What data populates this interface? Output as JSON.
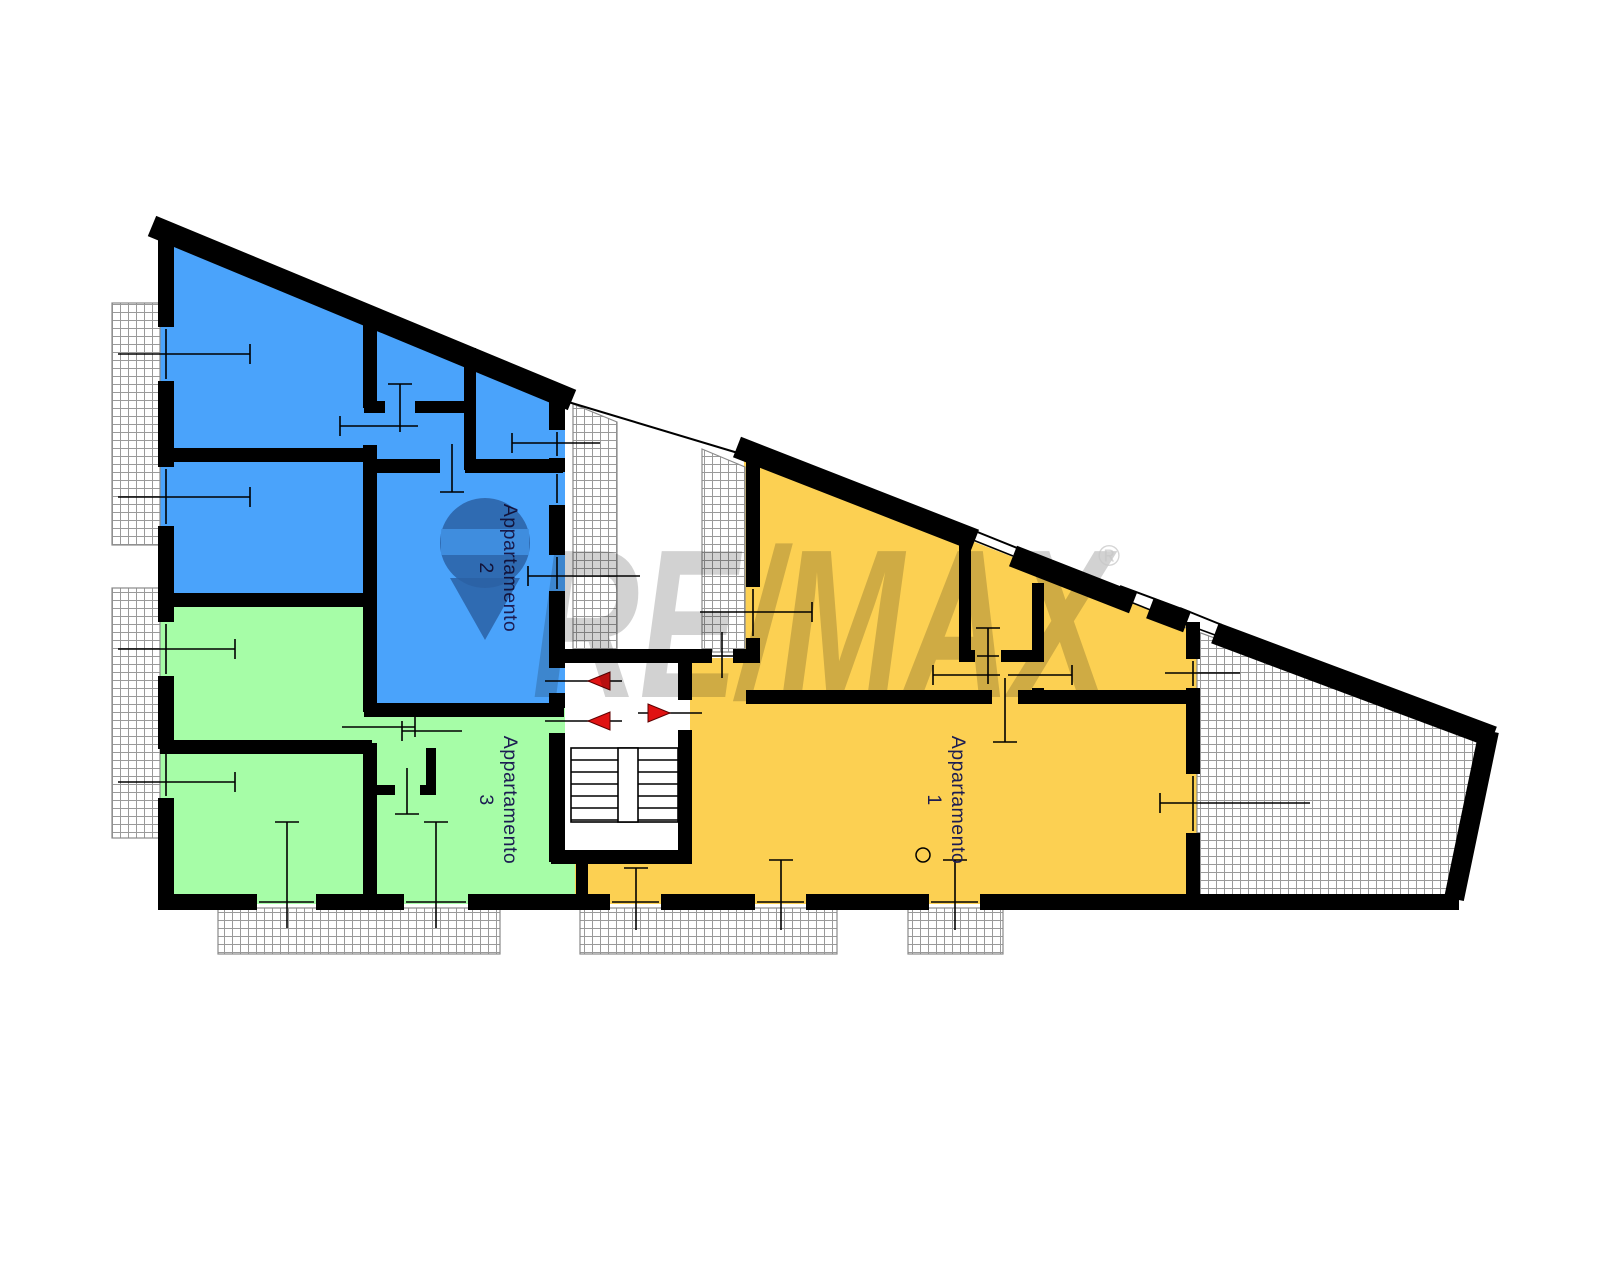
{
  "labels": {
    "apartment1": "Appartamento 1",
    "apartment2": "Appartamento 2",
    "apartment3": "Appartamento 3"
  },
  "watermark": {
    "text": "RE/MAX",
    "registered": "®",
    "x": 532,
    "y": 697,
    "font_size": 212,
    "text_length": 578,
    "reg_x": 1098,
    "reg_y": 566,
    "balloon": {
      "cx": 485,
      "cy": 543,
      "r": 45,
      "band": [
        441,
        529,
        88,
        26
      ],
      "tip": "450,578 520,578 485,640"
    }
  },
  "colors": {
    "apartment1": "#FCD052",
    "apartment2": "#4AA3FB",
    "apartment3": "#A6FDA7",
    "wall": "#000000",
    "hatch_line": "#9a9a9a",
    "hatch_border": "#8a8a8a",
    "door_marker": "#E01212",
    "door_marker_edge": "#5d0000",
    "label_text": "#1c1c52",
    "watermark_gray": "#c7c7c7",
    "balloon_gray": "#9298a8",
    "balloon_band": "#dfe2e8"
  },
  "floorplan": {
    "fills": [
      {
        "name": "apartment-2-area",
        "shape": "poly",
        "color": "apartment2",
        "pts": [
          "158,233",
          "565,402",
          "565,705",
          "363,705",
          "363,604",
          "158,604"
        ]
      },
      {
        "name": "apartment-3-area",
        "shape": "rect",
        "color": "apartment3",
        "rect": [
          158,
          598,
          214,
          306
        ]
      },
      {
        "name": "apartment-3-area",
        "shape": "rect",
        "color": "apartment3",
        "rect": [
          363,
          703,
          202,
          201
        ]
      },
      {
        "name": "apartment-3-area",
        "shape": "rect",
        "color": "apartment3",
        "rect": [
          549,
          858,
          30,
          46
        ]
      },
      {
        "name": "apartment-1-area",
        "shape": "poly",
        "color": "apartment1",
        "pts": [
          "744,452",
          "1200,630",
          "1200,904",
          "575,904",
          "575,855",
          "690,855",
          "690,658",
          "744,658"
        ]
      }
    ],
    "hatch_areas": [
      {
        "name": "balcony-top-left",
        "shape": "rect",
        "rect": [
          112,
          303,
          48,
          242
        ]
      },
      {
        "name": "balcony-left",
        "shape": "rect",
        "rect": [
          112,
          588,
          48,
          250
        ]
      },
      {
        "name": "balcony-bottom-left",
        "shape": "rect",
        "rect": [
          218,
          908,
          282,
          46
        ]
      },
      {
        "name": "balcony-bottom-center",
        "shape": "rect",
        "rect": [
          580,
          908,
          257,
          46
        ]
      },
      {
        "name": "balcony-bottom-right",
        "shape": "rect",
        "rect": [
          908,
          908,
          95,
          46
        ]
      },
      {
        "name": "light-well-1",
        "shape": "poly",
        "pts": [
          "573,404",
          "617,422",
          "617,651",
          "573,651"
        ]
      },
      {
        "name": "light-well-2",
        "shape": "poly",
        "pts": [
          "702,449",
          "745,467",
          "745,652",
          "702,652"
        ]
      },
      {
        "name": "terrace",
        "shape": "poly",
        "pts": [
          "1165,620",
          "1490,738",
          "1453,900",
          "1197,900",
          "1197,632"
        ]
      }
    ],
    "walls": [
      [
        152,
        226,
        572,
        400,
        22
      ],
      [
        166,
        228,
        166,
        327,
        16
      ],
      [
        166,
        381,
        166,
        467,
        16
      ],
      [
        166,
        526,
        166,
        622,
        16
      ],
      [
        166,
        676,
        166,
        749,
        16
      ],
      [
        166,
        798,
        166,
        908,
        16
      ],
      [
        158,
        902,
        257,
        902,
        16
      ],
      [
        316,
        902,
        404,
        902,
        16
      ],
      [
        468,
        902,
        610,
        902,
        16
      ],
      [
        661,
        902,
        755,
        902,
        16
      ],
      [
        806,
        902,
        929,
        902,
        16
      ],
      [
        980,
        902,
        1459,
        902,
        16
      ],
      [
        737,
        447,
        975,
        540,
        22
      ],
      [
        1013,
        556,
        1133,
        603,
        22
      ],
      [
        1150,
        608,
        1187,
        622,
        22
      ],
      [
        1215,
        633,
        1493,
        737,
        22
      ],
      [
        1489,
        731,
        1454,
        899,
        20
      ],
      [
        160,
        455,
        372,
        455,
        14
      ],
      [
        370,
        323,
        370,
        408,
        14
      ],
      [
        370,
        445,
        370,
        712,
        14
      ],
      [
        370,
        743,
        370,
        896,
        14
      ],
      [
        364,
        407,
        385,
        407,
        12
      ],
      [
        415,
        407,
        474,
        407,
        12
      ],
      [
        470,
        348,
        470,
        470,
        12
      ],
      [
        364,
        466,
        440,
        466,
        14
      ],
      [
        465,
        466,
        563,
        466,
        14
      ],
      [
        557,
        398,
        557,
        430,
        16
      ],
      [
        557,
        458,
        557,
        472,
        16
      ],
      [
        557,
        505,
        557,
        555,
        16
      ],
      [
        557,
        591,
        557,
        668,
        16
      ],
      [
        557,
        693,
        557,
        708,
        16
      ],
      [
        557,
        733,
        557,
        862,
        16
      ],
      [
        160,
        600,
        372,
        600,
        14
      ],
      [
        160,
        747,
        372,
        747,
        14
      ],
      [
        364,
        710,
        564,
        710,
        14
      ],
      [
        431,
        710,
        431,
        716,
        10
      ],
      [
        431,
        748,
        431,
        794,
        10
      ],
      [
        372,
        790,
        395,
        790,
        10
      ],
      [
        420,
        790,
        436,
        790,
        10
      ],
      [
        582,
        852,
        582,
        904,
        12
      ],
      [
        551,
        656,
        712,
        656,
        14
      ],
      [
        733,
        656,
        760,
        656,
        14
      ],
      [
        685,
        649,
        685,
        700,
        14
      ],
      [
        685,
        730,
        685,
        864,
        14
      ],
      [
        551,
        857,
        692,
        857,
        14
      ],
      [
        753,
        449,
        753,
        587,
        14
      ],
      [
        753,
        638,
        753,
        663,
        14
      ],
      [
        746,
        697,
        992,
        697,
        14
      ],
      [
        1018,
        697,
        1200,
        697,
        14
      ],
      [
        959,
        656,
        975,
        656,
        12
      ],
      [
        1001,
        656,
        1044,
        656,
        12
      ],
      [
        965,
        538,
        965,
        662,
        12
      ],
      [
        965,
        690,
        965,
        703,
        12
      ],
      [
        1038,
        583,
        1038,
        662,
        12
      ],
      [
        1038,
        688,
        1038,
        703,
        12
      ],
      [
        1193,
        622,
        1193,
        659,
        14
      ],
      [
        1193,
        688,
        1193,
        774,
        14
      ],
      [
        1193,
        833,
        1193,
        908,
        14
      ]
    ],
    "thin_lines": [
      [
        565,
        401,
        748,
        456
      ],
      [
        965,
        527,
        1022,
        550
      ],
      [
        1120,
        586,
        1190,
        612
      ],
      [
        1180,
        608,
        1222,
        625
      ]
    ],
    "tick_lines": [
      [
        118,
        354,
        250,
        354
      ],
      [
        250,
        344,
        250,
        364
      ],
      [
        166,
        329,
        166,
        379
      ],
      [
        118,
        497,
        250,
        497
      ],
      [
        250,
        487,
        250,
        507
      ],
      [
        166,
        469,
        166,
        524
      ],
      [
        118,
        649,
        235,
        649
      ],
      [
        235,
        639,
        235,
        659
      ],
      [
        166,
        624,
        166,
        674
      ],
      [
        118,
        782,
        235,
        782
      ],
      [
        235,
        772,
        235,
        792
      ],
      [
        166,
        751,
        166,
        796
      ],
      [
        287,
        822,
        287,
        928
      ],
      [
        275,
        822,
        299,
        822
      ],
      [
        259,
        902,
        314,
        902
      ],
      [
        436,
        822,
        436,
        928
      ],
      [
        424,
        822,
        448,
        822
      ],
      [
        406,
        902,
        466,
        902
      ],
      [
        636,
        868,
        636,
        930
      ],
      [
        624,
        868,
        648,
        868
      ],
      [
        612,
        902,
        659,
        902
      ],
      [
        781,
        860,
        781,
        930
      ],
      [
        769,
        860,
        793,
        860
      ],
      [
        757,
        902,
        804,
        902
      ],
      [
        955,
        860,
        955,
        930
      ],
      [
        943,
        860,
        967,
        860
      ],
      [
        931,
        902,
        978,
        902
      ],
      [
        512,
        443,
        600,
        443
      ],
      [
        512,
        433,
        512,
        453
      ],
      [
        557,
        432,
        557,
        456
      ],
      [
        557,
        474,
        557,
        503
      ],
      [
        528,
        576,
        640,
        576
      ],
      [
        528,
        566,
        528,
        586
      ],
      [
        557,
        557,
        557,
        589
      ],
      [
        700,
        612,
        812,
        612
      ],
      [
        812,
        602,
        812,
        622
      ],
      [
        753,
        589,
        753,
        636
      ],
      [
        722,
        632,
        722,
        678
      ],
      [
        712,
        656,
        733,
        656
      ],
      [
        988,
        628,
        988,
        684
      ],
      [
        976,
        628,
        1000,
        628
      ],
      [
        977,
        656,
        999,
        656
      ],
      [
        933,
        675,
        1000,
        675
      ],
      [
        933,
        665,
        933,
        685
      ],
      [
        1008,
        675,
        1072,
        675
      ],
      [
        1072,
        665,
        1072,
        685
      ],
      [
        1005,
        678,
        1005,
        742
      ],
      [
        993,
        742,
        1017,
        742
      ],
      [
        1165,
        673,
        1240,
        673
      ],
      [
        1193,
        661,
        1193,
        686
      ],
      [
        1160,
        803,
        1310,
        803
      ],
      [
        1160,
        793,
        1160,
        813
      ],
      [
        1193,
        776,
        1193,
        831
      ],
      [
        973,
        540,
        1013,
        556
      ],
      [
        1128,
        601,
        1178,
        621
      ],
      [
        1185,
        624,
        1215,
        635
      ],
      [
        340,
        426,
        418,
        426
      ],
      [
        340,
        416,
        340,
        436
      ],
      [
        342,
        727,
        415,
        727
      ],
      [
        415,
        717,
        415,
        737
      ],
      [
        400,
        384,
        400,
        432
      ],
      [
        388,
        384,
        412,
        384
      ],
      [
        452,
        444,
        452,
        492
      ],
      [
        440,
        492,
        464,
        492
      ],
      [
        402,
        731,
        462,
        731
      ],
      [
        402,
        721,
        402,
        741
      ],
      [
        407,
        768,
        407,
        814
      ],
      [
        395,
        814,
        419,
        814
      ],
      [
        545,
        681,
        622,
        681
      ],
      [
        545,
        721,
        622,
        721
      ],
      [
        638,
        713,
        702,
        713
      ]
    ],
    "stairs": {
      "outline": [
        571,
        748,
        107,
        74
      ],
      "divider": [
        618,
        748,
        20,
        74
      ],
      "tread_ys": [
        760,
        772,
        784,
        796,
        808,
        820
      ],
      "left_flight_x": [
        571,
        618
      ],
      "right_flight_x": [
        638,
        678
      ]
    },
    "door_triangles": [
      {
        "name": "entrance-arrow-apartment-2",
        "pts": "610,672 610,690 588,681"
      },
      {
        "name": "entrance-arrow-apartment-3",
        "pts": "610,712 610,730 588,721"
      },
      {
        "name": "entrance-arrow-apartment-1",
        "pts": "648,704 648,722 670,713"
      }
    ],
    "circle_symbol": {
      "cx": 923,
      "cy": 855,
      "r": 7
    },
    "room_labels": [
      {
        "key": "apartment2",
        "x": 500,
        "y": 568
      },
      {
        "key": "apartment3",
        "x": 500,
        "y": 800
      },
      {
        "key": "apartment1",
        "x": 948,
        "y": 800
      }
    ],
    "label_font_size": 19.5
  }
}
